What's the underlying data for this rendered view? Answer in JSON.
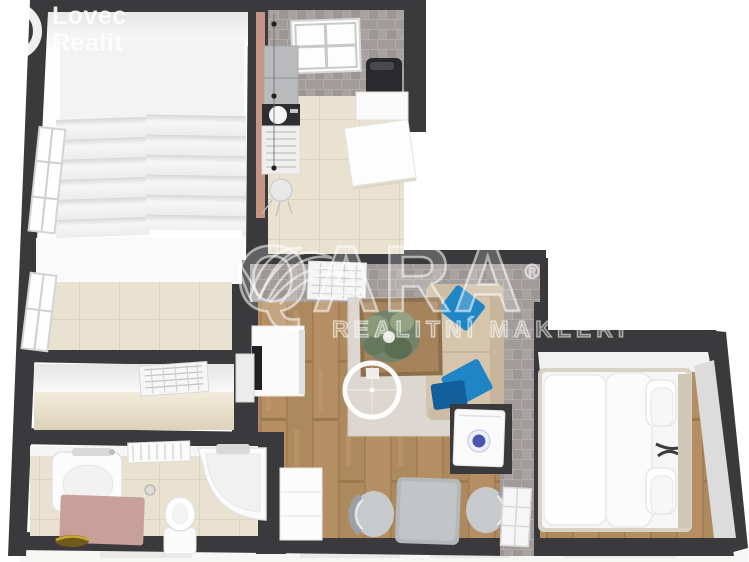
{
  "branding": {
    "line1": "Lovec",
    "line2": "Realit"
  },
  "watermark": {
    "brand": "QARA",
    "registered": "®",
    "tagline": "REALITNÍ MAKLÉŘI"
  },
  "icons": {
    "logo_icon": "ring-icon",
    "watermark_icon": "palm-leaves-icon",
    "camera_marker_icon": "360-camera-ring-icon"
  },
  "colors": {
    "wall": "#3a3a3c",
    "brick_wall": "#a5a09d",
    "salmon_wall": "#c69584",
    "wood_floor": "#b28d60",
    "tile_floor": "#e9e2d0",
    "hall_floor": "#e7decb",
    "rug": "#dcd7d1",
    "sofa": "#d5c5ad",
    "pillow_blue": "#1f85c5",
    "pillow_blue_dark": "#135f9b",
    "mat_pink": "#c7a099",
    "table_gray": "#b5b8ba",
    "watermark": "rgba(255,255,255,0.55)"
  }
}
